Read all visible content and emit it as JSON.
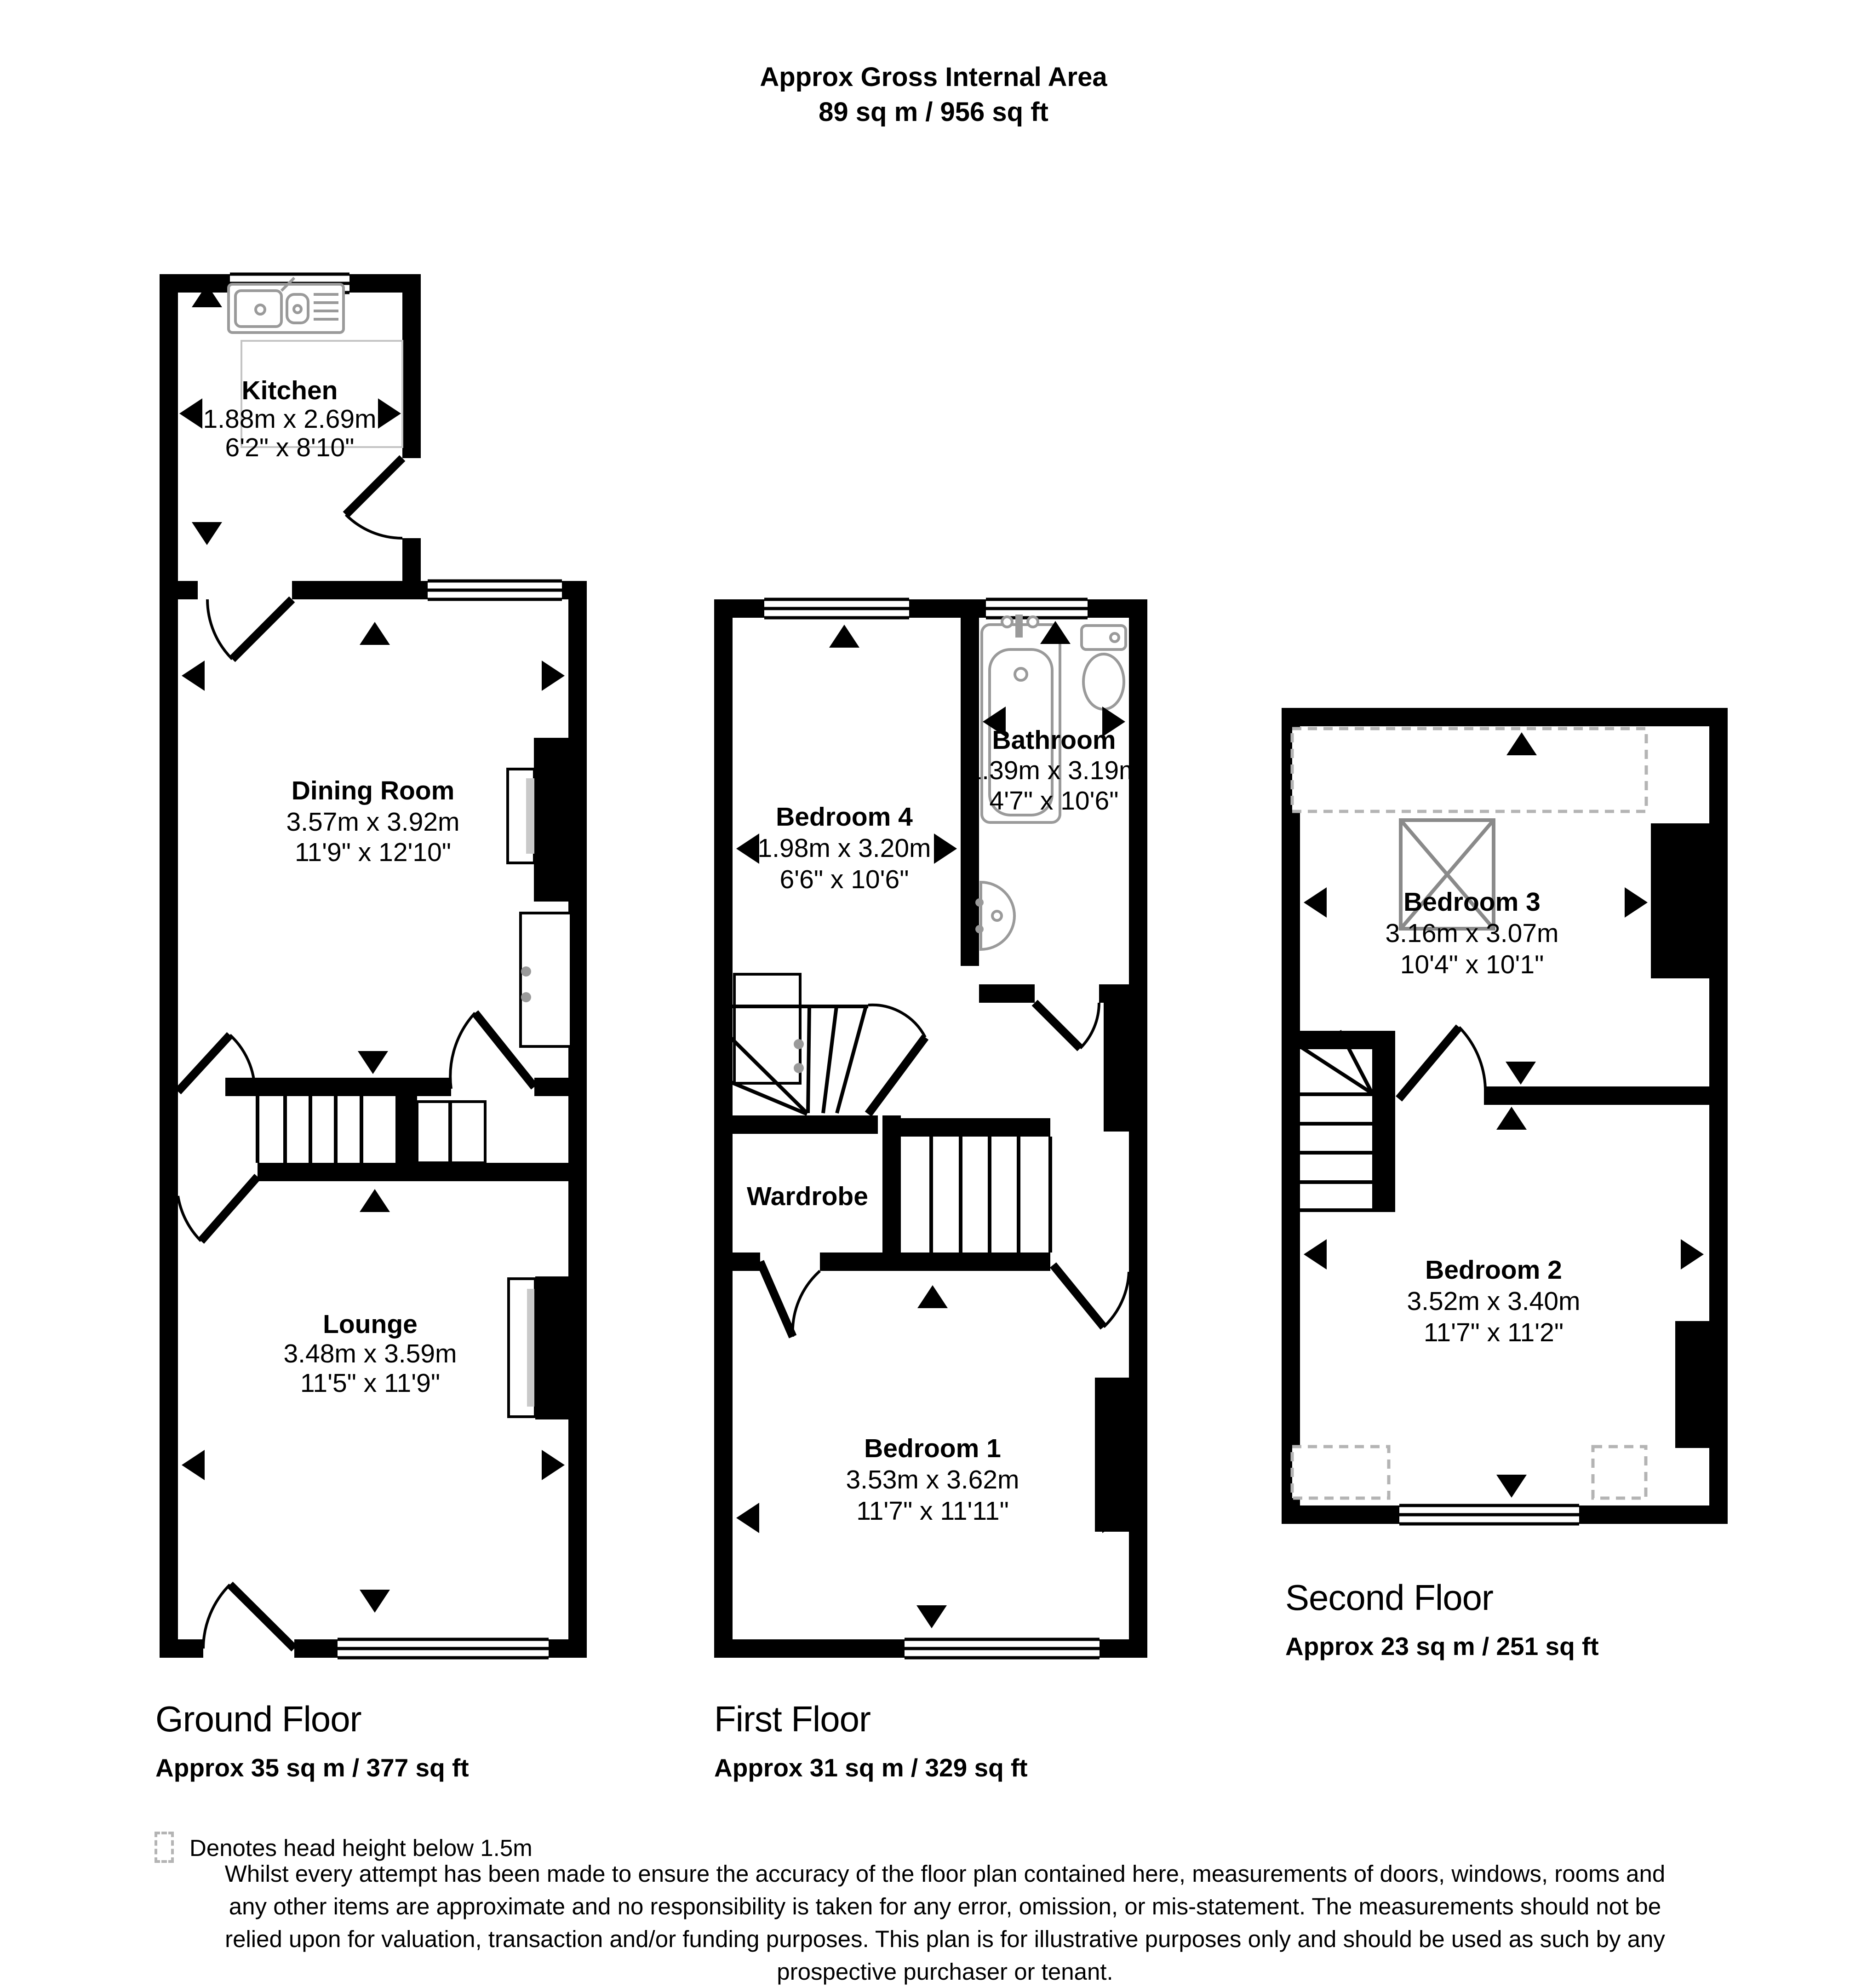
{
  "title": {
    "line1": "Approx Gross Internal Area",
    "line2": "89 sq m / 956 sq ft"
  },
  "floors": {
    "ground": {
      "label": "Ground Floor",
      "area": "Approx 35 sq m / 377 sq ft"
    },
    "first": {
      "label": "First Floor",
      "area": "Approx 31 sq m / 329 sq ft"
    },
    "second": {
      "label": "Second Floor",
      "area": "Approx 23 sq m / 251 sq ft"
    }
  },
  "rooms": {
    "kitchen": {
      "name": "Kitchen",
      "metric": "1.88m x 2.69m",
      "imperial": "6'2\" x 8'10\""
    },
    "dining_room": {
      "name": "Dining Room",
      "metric": "3.57m x 3.92m",
      "imperial": "11'9\" x 12'10\""
    },
    "lounge": {
      "name": "Lounge",
      "metric": "3.48m x 3.59m",
      "imperial": "11'5\" x 11'9\""
    },
    "bedroom4": {
      "name": "Bedroom 4",
      "metric": "1.98m x 3.20m",
      "imperial": "6'6\" x 10'6\""
    },
    "bathroom": {
      "name": "Bathroom",
      "metric": "1.39m x 3.19m",
      "imperial": "4'7\" x 10'6\""
    },
    "wardrobe": {
      "name": "Wardrobe"
    },
    "bedroom1": {
      "name": "Bedroom 1",
      "metric": "3.53m x 3.62m",
      "imperial": "11'7\" x 11'11\""
    },
    "bedroom3": {
      "name": "Bedroom 3",
      "metric": "3.16m x 3.07m",
      "imperial": "10'4\" x 10'1\""
    },
    "bedroom2": {
      "name": "Bedroom 2",
      "metric": "3.52m x 3.40m",
      "imperial": "11'7\" x 11'2\""
    }
  },
  "legend": {
    "head_height_note": "Denotes head height below 1.5m"
  },
  "disclaimer": {
    "line1": "Whilst every attempt has been made to ensure the accuracy of the floor plan contained here, measurements of doors, windows, rooms and",
    "line2": "any other items are approximate and no responsibility is taken for any error, omission, or mis-statement. The measurements should not be",
    "line3": "relied upon for valuation, transaction and/or funding purposes. This plan is for illustrative purposes only and should be used as such by any",
    "line4": "prospective purchaser or tenant."
  },
  "colors": {
    "wall": "#000000",
    "head_height_dash": "#b4b4b4",
    "fixture_stroke": "#9a9a9a",
    "background": "#ffffff"
  }
}
